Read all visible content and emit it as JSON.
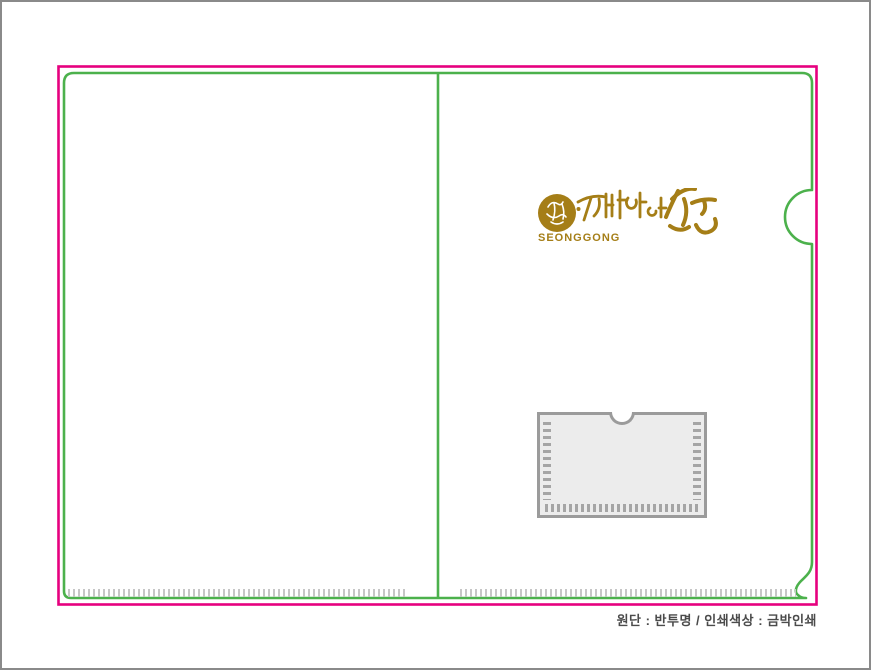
{
  "artboard": {
    "width_px": 871,
    "height_px": 670,
    "frame_color": "#8a8a8a",
    "background_color": "#ffffff"
  },
  "diecut": {
    "cut_line_color": "#e6007e",
    "fold_outline_color": "#4cb14c",
    "serration_tick_color": "#c6c6c6",
    "panels": 2,
    "thumb_notch_side": "right"
  },
  "logo": {
    "seal_icon": "circular-brush-seal",
    "calligraphy_text": "성공",
    "wordmark": "SEONGGONG",
    "gold_color": "#a57e17"
  },
  "pocket": {
    "border_color": "#9b9b9b",
    "fill_color": "#ececec",
    "stitch_color": "#a5a5a5",
    "notch": "top-center-semicircle"
  },
  "caption": {
    "text": "원단 : 반투명 / 인쇄색상 : 금박인쇄",
    "color": "#4b4b4b"
  }
}
